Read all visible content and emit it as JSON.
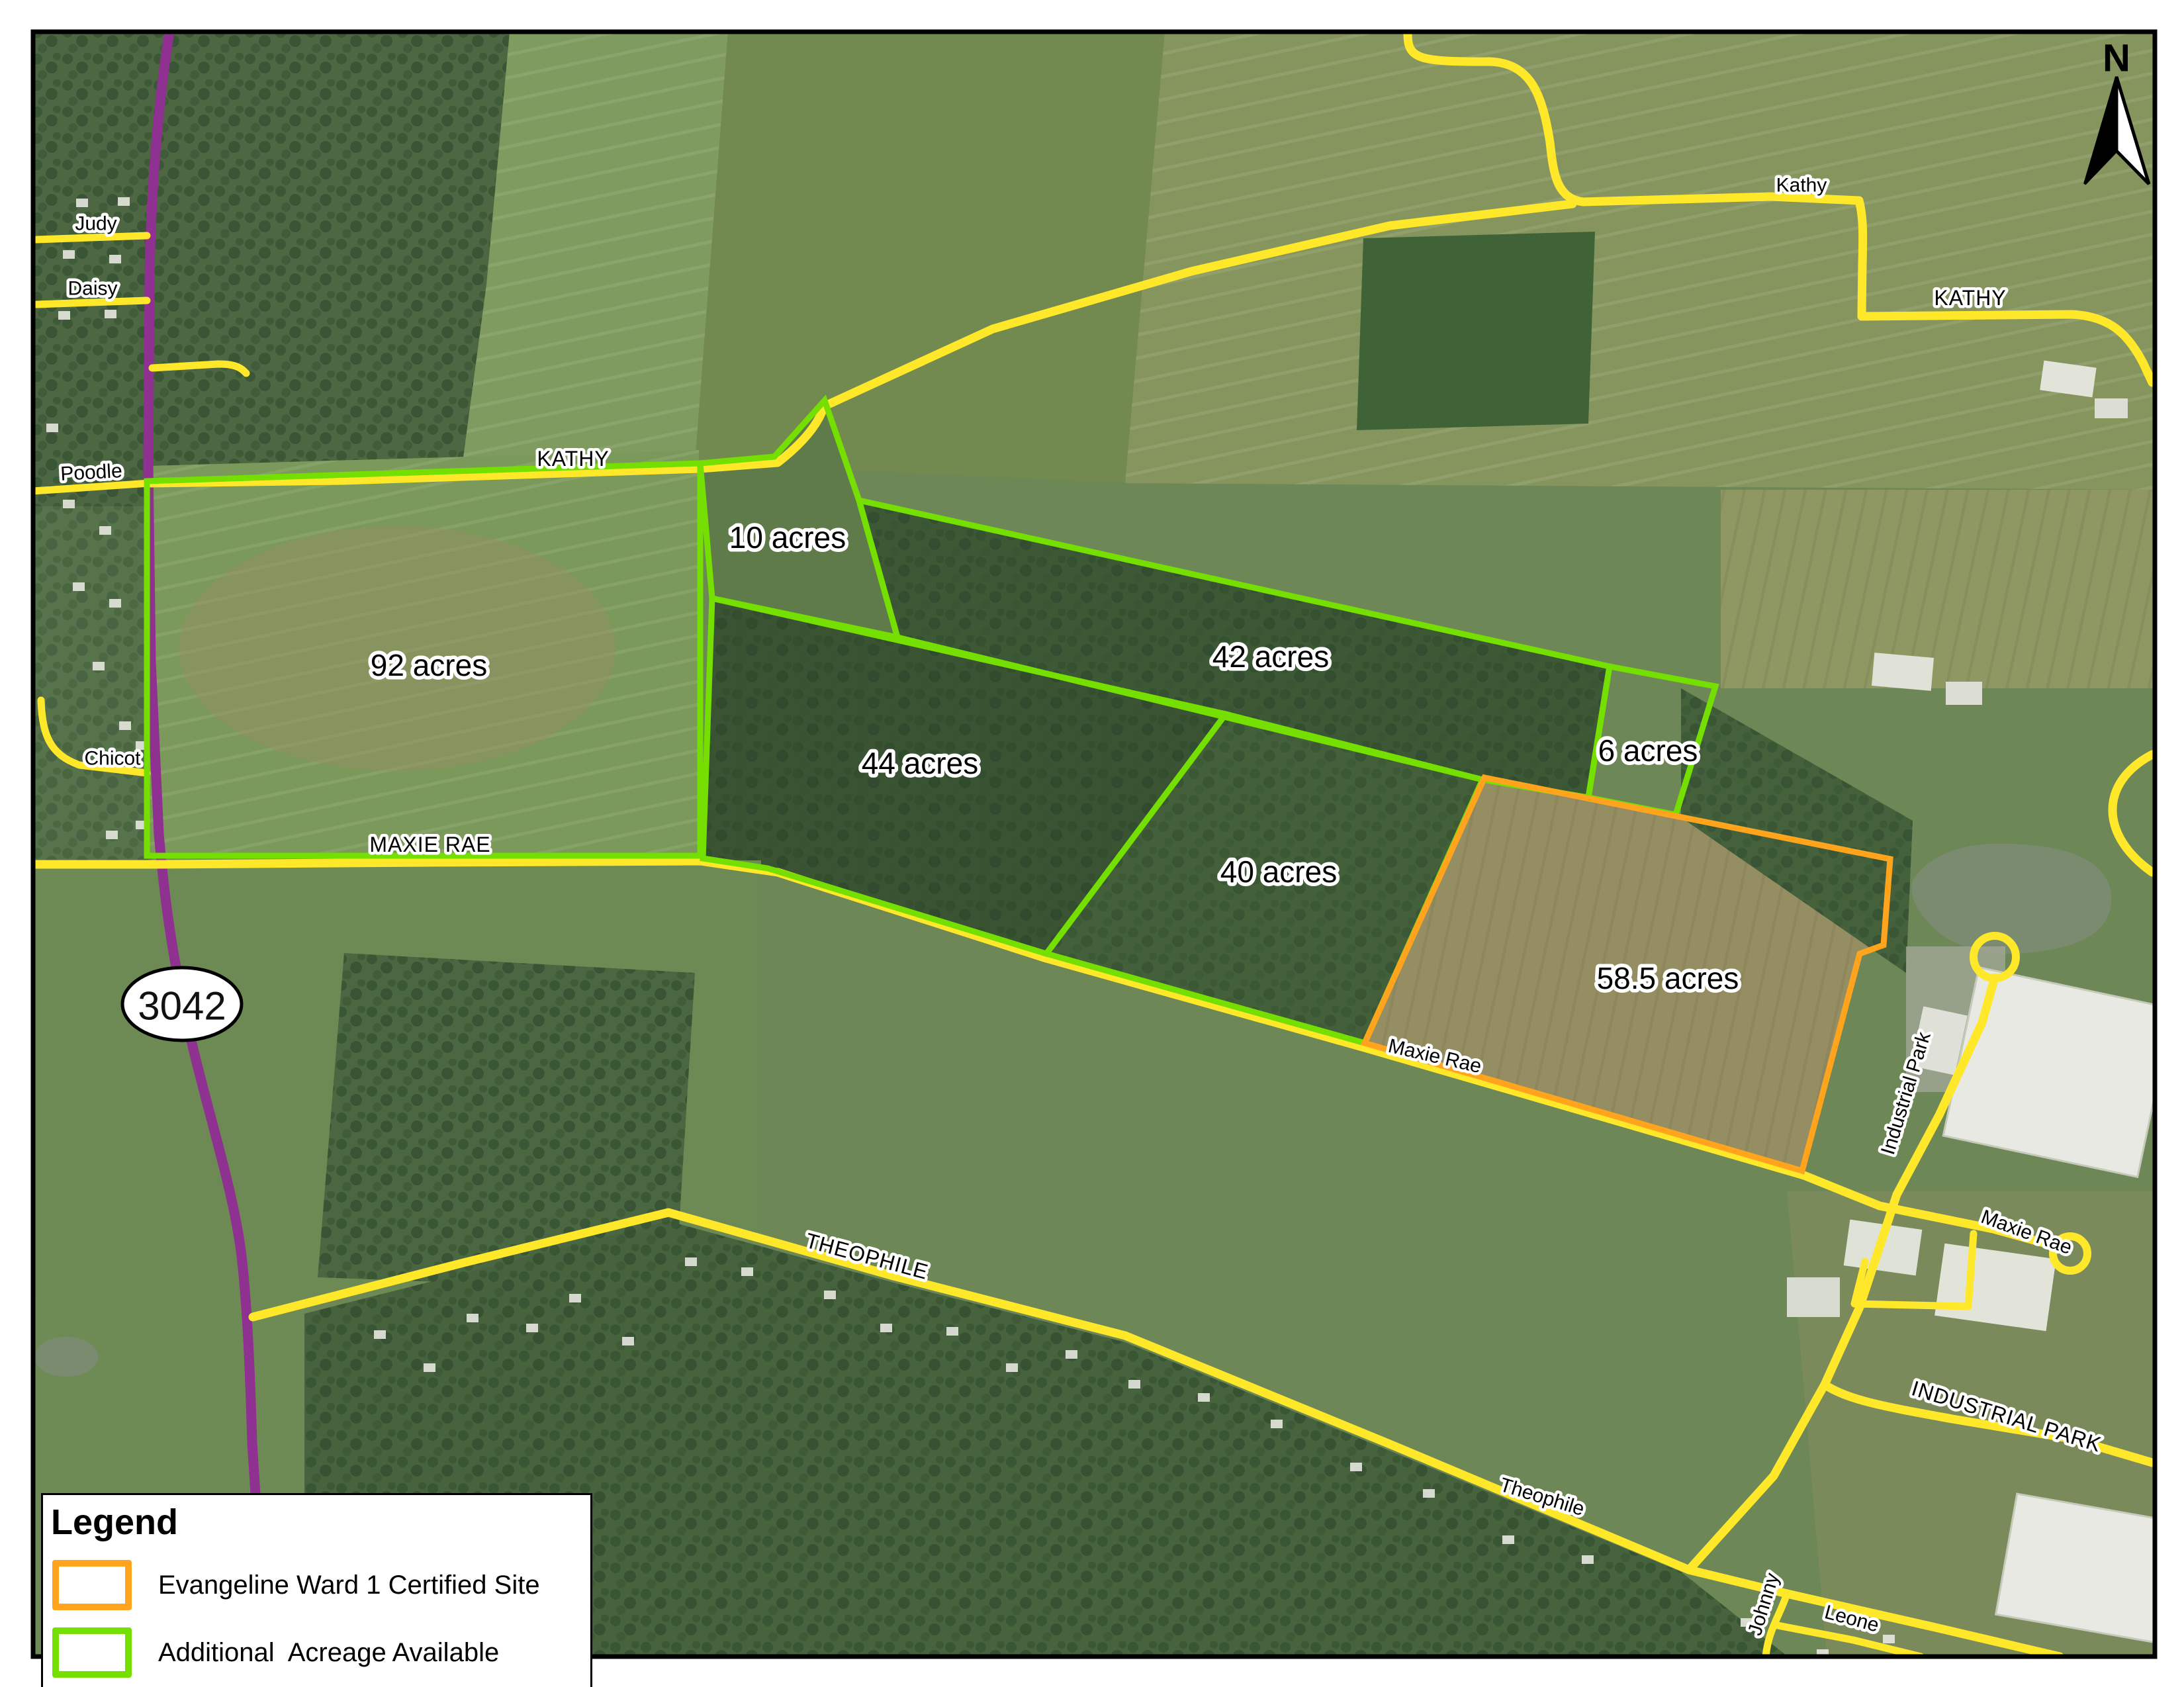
{
  "map": {
    "north_label": "N",
    "route_shield": {
      "text": "3042"
    },
    "parcels": [
      {
        "label": "92 acres",
        "acres": 92,
        "type": "available"
      },
      {
        "label": "10 acres",
        "acres": 10,
        "type": "available"
      },
      {
        "label": "42 acres",
        "acres": 42,
        "type": "available"
      },
      {
        "label": "44 acres",
        "acres": 44,
        "type": "available"
      },
      {
        "label": "6 acres",
        "acres": 6,
        "type": "available"
      },
      {
        "label": "40 acres",
        "acres": 40,
        "type": "available"
      },
      {
        "label": "58.5 acres",
        "acres": 58.5,
        "type": "certified"
      }
    ],
    "road_labels": [
      {
        "text": "Judy"
      },
      {
        "text": "Daisy"
      },
      {
        "text": "Poodle"
      },
      {
        "text": "Chicot"
      },
      {
        "text": "KATHY"
      },
      {
        "text": "Kathy"
      },
      {
        "text": "KATHY"
      },
      {
        "text": "MAXIE RAE"
      },
      {
        "text": "Maxie Rae"
      },
      {
        "text": "Maxie Rae"
      },
      {
        "text": "Industrial Park"
      },
      {
        "text": "THEOPHILE"
      },
      {
        "text": "Theophile"
      },
      {
        "text": "INDUSTRIAL PARK"
      },
      {
        "text": "Johnny"
      },
      {
        "text": "Leone"
      }
    ]
  },
  "legend": {
    "title": "Legend",
    "items": [
      {
        "label": "Evangeline Ward 1 Certified Site",
        "type": "certified"
      },
      {
        "label": "Additional  Acreage Available",
        "type": "available"
      }
    ]
  },
  "colors": {
    "certified": "#FFA41C",
    "available": "#74DF00",
    "road": "#FFE829",
    "highway": "#8E3190"
  }
}
